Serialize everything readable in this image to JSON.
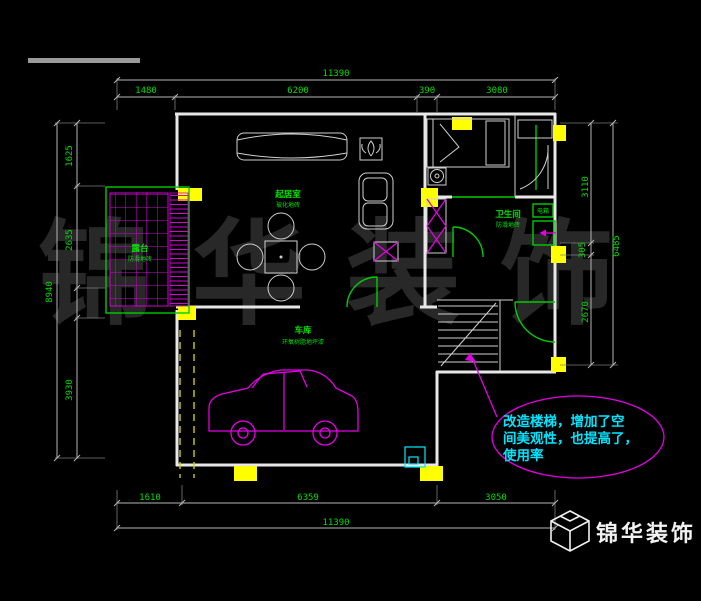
{
  "watermark": "锦华装饰",
  "logo": {
    "name": "锦华装饰"
  },
  "dimensions": {
    "top": {
      "total": "11390",
      "seg1": "1480",
      "seg2": "6200",
      "seg3": "390",
      "seg4": "3080"
    },
    "bottom": {
      "total": "11390",
      "seg1": "1610",
      "seg2": "6359",
      "seg3": "3050"
    },
    "left": {
      "total": "8940",
      "seg1": "1625",
      "seg2": "2635",
      "seg3": "3930"
    },
    "right": {
      "total": "6485",
      "seg1": "3110",
      "seg2": "305",
      "seg3": "2670"
    }
  },
  "rooms": {
    "terrace": {
      "name": "露台",
      "floor": "防滑地砖"
    },
    "living": {
      "name": "起居室",
      "floor": "玻化地砖"
    },
    "garage": {
      "name": "车库",
      "floor": "环氧树脂地坪漆"
    },
    "bath": {
      "name": "卫生间",
      "floor": "防滑地砖"
    },
    "panel": {
      "name": "电箱"
    }
  },
  "annotation": {
    "line1": "改造楼梯，增加了空",
    "line2": "间美观性，也提高了，",
    "line3": "使用率"
  },
  "colors": {
    "dim_text": "#00dc00",
    "walls": "#e8e8e8",
    "columns": "#ffff00",
    "car": "#e400e4",
    "callout": "#00e5ff",
    "watermark": "#282828"
  }
}
